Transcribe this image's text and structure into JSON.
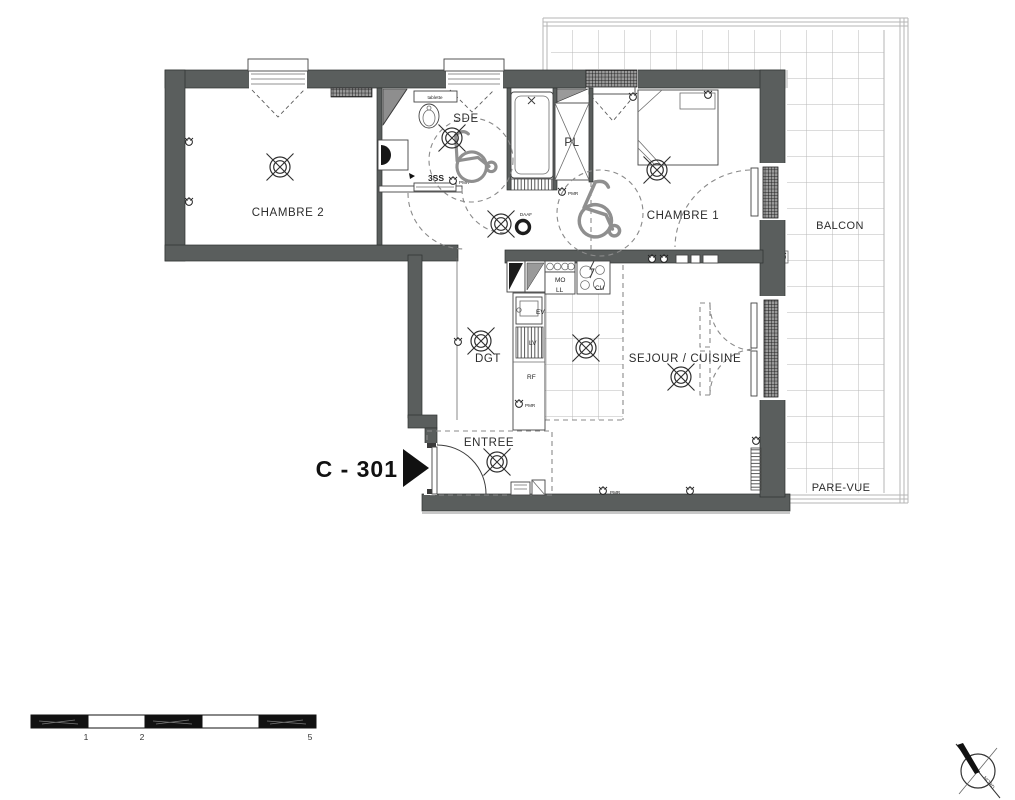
{
  "plan": {
    "unit_label": "C - 301",
    "rooms": {
      "chambre2": "CHAMBRE 2",
      "sde": "SDE",
      "pl": "PL",
      "chambre1": "CHAMBRE 1",
      "balcon": "BALCON",
      "dgt": "DGT",
      "sejour_cuisine": "SEJOUR / CUISINE",
      "entree": "ENTREE",
      "pare_vue": "PARE-VUE"
    },
    "fixtures": {
      "tablette": "tablette",
      "seche_serviettes": "3SS",
      "evier": "EV",
      "lave_vaisselle": "LV",
      "refrigerateur": "RF",
      "micro_ondes": "MO",
      "lave_linge": "LL",
      "cuisson": "CU"
    },
    "annotations": {
      "pmr": "PMR",
      "daaf": "DAAF"
    },
    "compass": {
      "north_label": "NORD"
    },
    "scale_bar": {
      "tick1": "1",
      "tick2": "2",
      "tick3": "5"
    }
  },
  "colors": {
    "wall": "#5a5e5d",
    "line": "#3c3c3c",
    "balcony_line": "#b5b5b5",
    "text": "#2d2d2d"
  }
}
